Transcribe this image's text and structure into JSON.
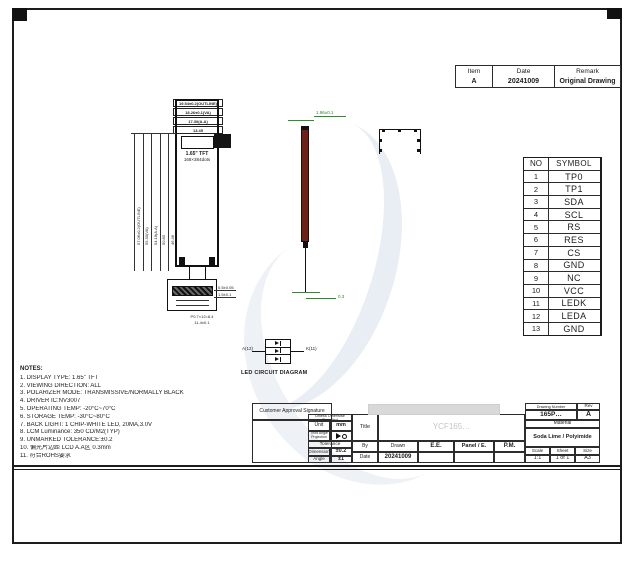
{
  "revision_table": {
    "headers": [
      "Item",
      "Date",
      "Remark"
    ],
    "rows": [
      [
        "A",
        "20241009",
        "Original Drawing"
      ]
    ]
  },
  "pin_table": {
    "headers": [
      "NO",
      "SYMBOL"
    ],
    "rows": [
      [
        "1",
        "TP0"
      ],
      [
        "2",
        "TP1"
      ],
      [
        "3",
        "SDA"
      ],
      [
        "4",
        "SCL"
      ],
      [
        "5",
        "RS"
      ],
      [
        "6",
        "RES"
      ],
      [
        "7",
        "CS"
      ],
      [
        "8",
        "GND"
      ],
      [
        "9",
        "NC"
      ],
      [
        "10",
        "VCC"
      ],
      [
        "11",
        "LEDK"
      ],
      [
        "12",
        "LEDA"
      ],
      [
        "13",
        "GND"
      ]
    ]
  },
  "notes": {
    "title": "NOTES:",
    "items": [
      "1. DISPLAY TYPE:    1.65\" TFT",
      "2. VIEWING DIRECTION: ALL",
      "3. POLARIZER MODE:   TRANSMISSIVE/NORMALLY BLACK",
      "4. DRIVER IC:NV3007",
      "5. OPERATING TEMP:    -20°C~70°C",
      "6. STORAGE TEMP:    -30°C~80°C",
      "7. BACK LIGHT: 1 CHIP-WHITE LED, 20MA,3.0V",
      "8. LCM Luminance: 350 CD/M2(TYP)",
      "9. UNMARKED TOLERANCE:±0.2",
      "10. 偏光片边距 LCD A.A区 0.3mm",
      "11. 符合ROHS要求"
    ]
  },
  "front_view": {
    "top_dims": [
      "19.54±0.2(OUTLINE)",
      "18.26±0.1(VA)",
      "17.30(A.A)",
      "13.45"
    ],
    "left_dims": [
      "57.06±0.2(OUTLINE)",
      "55.30(VA)",
      "54.18(A.A)",
      "50.80",
      "46.46"
    ],
    "display_line1": "1.65\" TFT",
    "display_line2": "168×384dots",
    "connector_dims": {
      "right1": "0.5±0.05",
      "right2": "1.5±0.1",
      "bottom1": "P0.7×12=8.4",
      "bottom2": "11.4±0.1"
    }
  },
  "side_view": {
    "top_dim": "1.96±0.1",
    "bottom_dim": "0.3"
  },
  "led_circuit": {
    "caption": "LED CIRCUIT DIAGRAM",
    "anode_label": "A(12)",
    "cathode_label": "K(11)"
  },
  "title_block": {
    "customer": "Customer Approval Signature",
    "spec_header": "Unless Otherwise Specified",
    "unit_label": "Unit",
    "unit_value": "mm",
    "projection_label": "Third Angle Projection",
    "tolerance_label": "Tolerance",
    "dimension_label": "Dimension",
    "dimension_value": "±0.2",
    "angle_label": "Angle",
    "angle_value": "±1",
    "title_label": "Title",
    "title_value": "YCF165…",
    "by_label": "By",
    "date_label": "Date",
    "date_value": "20241009",
    "drawn_label": "Drawn",
    "drawn_value": "E.E.",
    "panel_label": "Panel / E.",
    "pm_label": "P.M.",
    "drawing_number_label": "Drawing Number",
    "drawing_number_value": "165P…",
    "rev_label": "Rev",
    "rev_value": "A",
    "material_label": "Material",
    "material_value": "Soda Lime / Polyimide",
    "scale_label": "Scale",
    "scale_value": "1:1",
    "sheet_label": "Sheet",
    "sheet_value": "1 of 1",
    "size_label": "Size",
    "size_value": "A3"
  }
}
